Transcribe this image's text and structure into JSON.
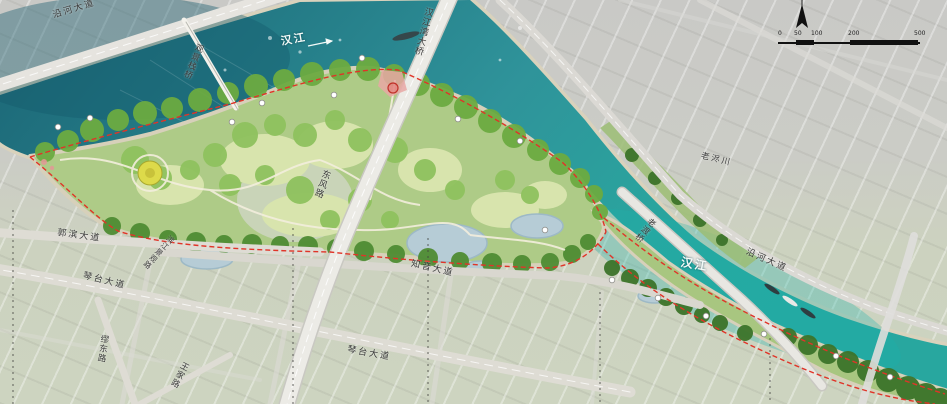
{
  "plan": {
    "river_name_upper": "汉江",
    "river_name_lower": "汉江",
    "bridge_main_label": "汉江湾大桥",
    "boardwalk_label": "观景栈桥",
    "ferry_bridge_label": "老渡桥",
    "stream_label": "老浕川",
    "roads": {
      "yanhe_upper": "沿河大道",
      "yanhe_lower": "沿河大道",
      "central_road": "东风路",
      "scenic_road": "滨江景观路",
      "zhiyin_avenue": "知音大道",
      "guobin_avenue": "郭滨大道",
      "qintai_avenue_west": "琴台大道",
      "qintai_avenue_center": "琴台大道",
      "miaodong_road": "缪东路",
      "wangjia_road": "王家路"
    },
    "scalebar": {
      "ticks": [
        "0",
        "50",
        "100",
        "200",
        "500"
      ]
    },
    "colors": {
      "water_dark": "#1f6e7c",
      "water_bright": "#2ba39d",
      "park_green": "#6cab41",
      "lawn": "#d8e4ad",
      "sand": "#d9d2bc",
      "boundary_red": "#e03428",
      "city_gray": "#c9c9c5"
    }
  }
}
